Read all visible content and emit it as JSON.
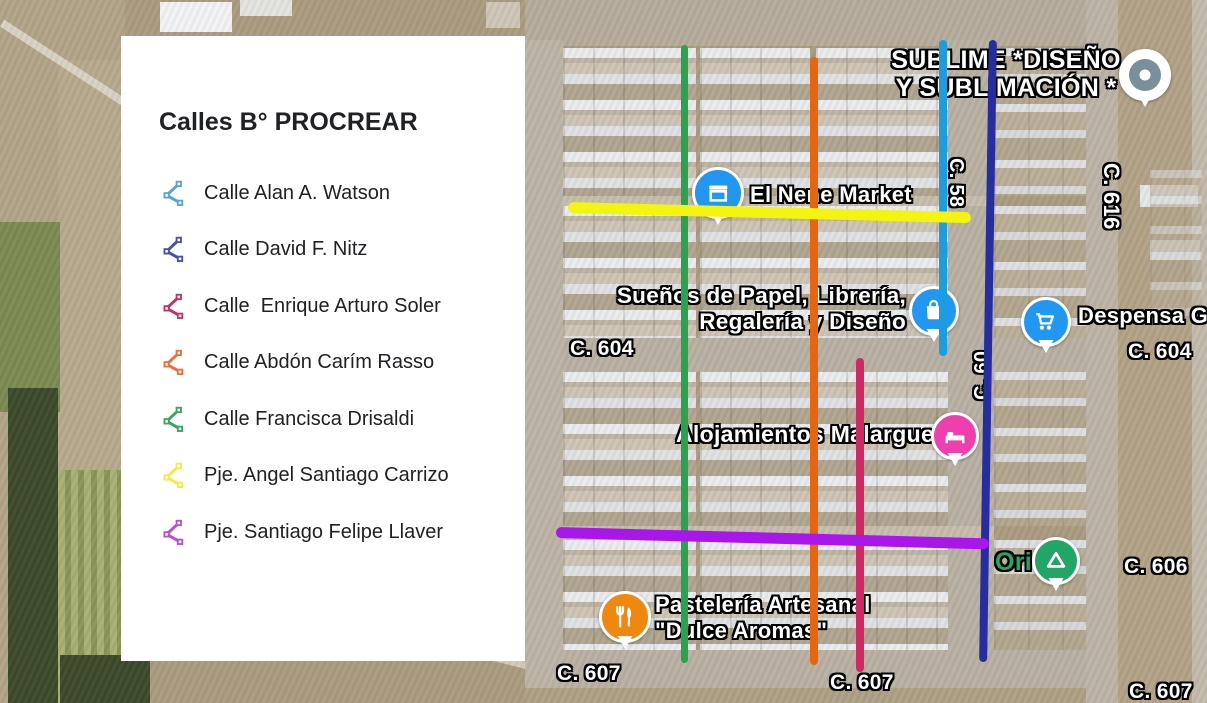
{
  "legend": {
    "title": "Calles B° PROCREAR",
    "icon": "route-polyline-icon",
    "items": [
      {
        "label": "Calle Alan A. Watson",
        "color": "#54a4dd"
      },
      {
        "label": "Calle David F. Nitz",
        "color": "#4c4fa4"
      },
      {
        "label": "Calle  Enrique Arturo Soler",
        "color": "#c03368"
      },
      {
        "label": "Calle Abdón Carím Rasso",
        "color": "#e9703c"
      },
      {
        "label": "Calle Francisca Drisaldi",
        "color": "#3ba465"
      },
      {
        "label": "Pje. Angel Santiago Carrizo",
        "color": "#efeb48"
      },
      {
        "label": "Pje. Santiago Felipe Llaver",
        "color": "#b44fe0"
      }
    ]
  },
  "map": {
    "overlay_lines": [
      {
        "street": "Calle Francisca Drisaldi",
        "color": "#27a44e",
        "direction": "vertical"
      },
      {
        "street": "Calle Abdón Carím Rasso",
        "color": "#e7650e",
        "direction": "vertical"
      },
      {
        "street": "Calle Alan A. Watson",
        "color": "#1b9de2",
        "direction": "vertical"
      },
      {
        "street": "Calle David F. Nitz",
        "color": "#252da0",
        "direction": "vertical"
      },
      {
        "street": "Calle Enrique Arturo Soler",
        "color": "#d02765",
        "direction": "vertical"
      },
      {
        "street": "Pje. Angel Santiago Carrizo",
        "color": "#f4f411",
        "direction": "horizontal"
      },
      {
        "street": "Pje. Santiago Felipe Llaver",
        "color": "#a816ea",
        "direction": "horizontal"
      }
    ],
    "street_labels": [
      {
        "text": "C. 604"
      },
      {
        "text": "C. 604"
      },
      {
        "text": "C. 606"
      },
      {
        "text": "C. 607"
      },
      {
        "text": "C. 607"
      },
      {
        "text": "C. 607"
      },
      {
        "text": "C. 616"
      },
      {
        "text": "C. 58"
      },
      {
        "text": "C. 60"
      }
    ],
    "pois": [
      {
        "label": "SUBLIME *DISEÑO",
        "label2": "Y SUBLIMACIÓN *",
        "pin_color": "#78909c",
        "icon": "circle-dot-marker-icon"
      },
      {
        "label": "El Nene Market",
        "pin_color": "#2196f3",
        "icon": "storefront-icon"
      },
      {
        "label": "Sueños de Papel, Librería,",
        "label2": "Regalería y Diseño",
        "pin_color": "#2196f3",
        "icon": "shopping-bag-icon"
      },
      {
        "label": "Despensa G",
        "pin_color": "#2196f3",
        "icon": "shopping-cart-icon"
      },
      {
        "label": "Alojamientos Malargue",
        "pin_color": "#ef3fae",
        "icon": "bed-icon"
      },
      {
        "label": "Ori",
        "pin_color": "#23a566",
        "label_color": "#23a566",
        "icon": "campground-icon"
      },
      {
        "label": "Pastelería Artesanal",
        "label2": "\"Dulce Aromas\"",
        "pin_color": "#f0870f",
        "icon": "restaurant-icon"
      }
    ]
  }
}
